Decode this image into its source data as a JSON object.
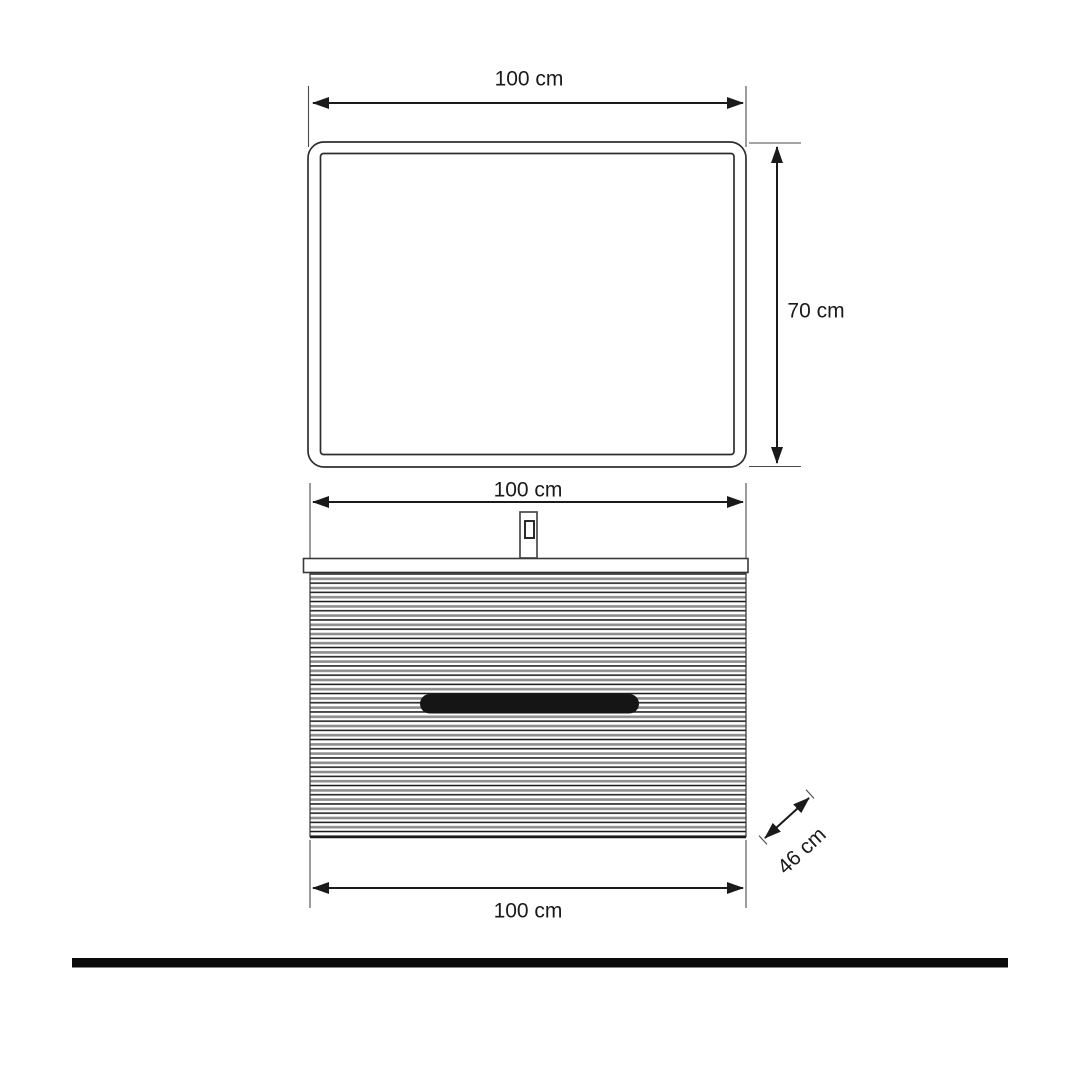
{
  "labels": {
    "mirror_width": "100 cm",
    "mirror_height": "70 cm",
    "cabinet_width_top": "100 cm",
    "cabinet_width_bottom": "100 cm",
    "cabinet_depth": "46 cm"
  },
  "colors": {
    "line": "#1a1a1a",
    "frame_stroke": "#2e2e2e",
    "flute_dark": "#161616",
    "flute_gray": "#8d8d8d",
    "handle": "#151515",
    "floor_bar": "#0a0a0a",
    "background": "#ffffff"
  }
}
